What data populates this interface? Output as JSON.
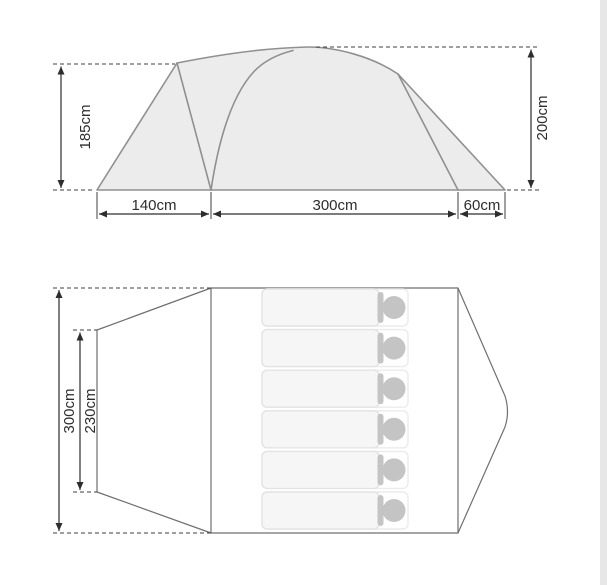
{
  "diagram": {
    "type": "tent-dimensions",
    "side_view": {
      "height_left_label": "185cm",
      "height_right_label": "200cm",
      "porch_width_label": "140cm",
      "main_width_label": "300cm",
      "rear_width_label": "60cm"
    },
    "top_view": {
      "outer_length_label": "300cm",
      "inner_length_label": "230cm",
      "sleeping_mat_count": 6
    },
    "colors": {
      "background": "#ffffff",
      "tent_fill": "#ececec",
      "tent_outline": "#909090",
      "plan_outline": "#6f6f6f",
      "dimension_ink": "#2d2d2d",
      "mat_body_fill": "#f6f6f6",
      "mat_border": "#e3e3e3",
      "pillow_grey": "#c4c4c4",
      "right_edge_strip": "#e7e7e7"
    }
  }
}
